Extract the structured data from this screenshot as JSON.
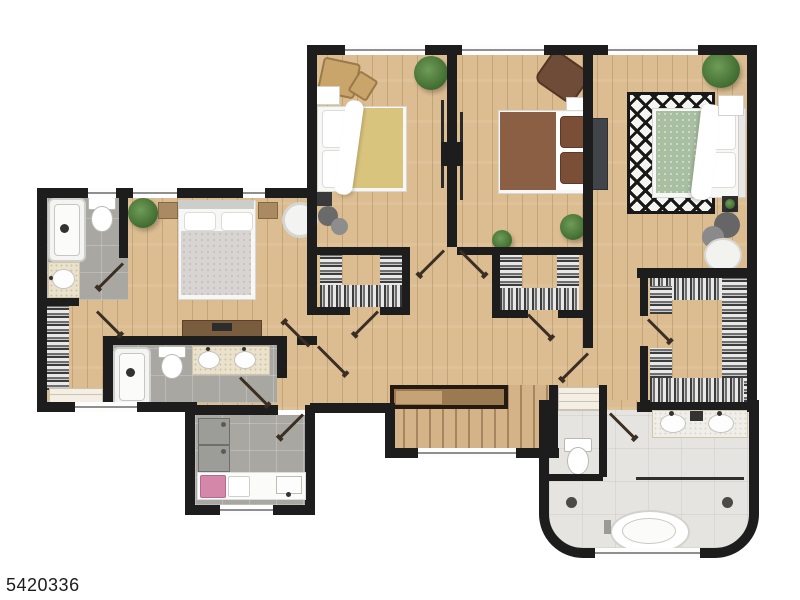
{
  "watermark": {
    "text": "5420336"
  },
  "palette": {
    "wall": "#1d1d1d",
    "wood_floor": "#dcbd92",
    "tile_gray": "#a9a7a2",
    "tile_light_marble": "#e5e4e0",
    "stair_wood": "#d4b388",
    "bed1_duvet_yellow": "#d9c47e",
    "bed2_duvet_brown": "#8a5f43",
    "bed3_duvet_green": "#a9bfa1",
    "bed4_duvet_gray": "#d8d4d2",
    "rug_black_white": "#181818",
    "laundry_basket_pink": "#d487a8",
    "plant_green": "#4a7a3c",
    "fixture_white": "#ffffff"
  },
  "rooms": [
    "bedroom-1",
    "bedroom-2",
    "bedroom-3",
    "bedroom-4",
    "walk-in-closet-1",
    "walk-in-closet-2",
    "walk-in-closet-3",
    "hall-closet",
    "bathroom-1",
    "hall-bathroom",
    "master-bathroom",
    "laundry-room",
    "hallway",
    "stairs",
    "linen-closet"
  ]
}
